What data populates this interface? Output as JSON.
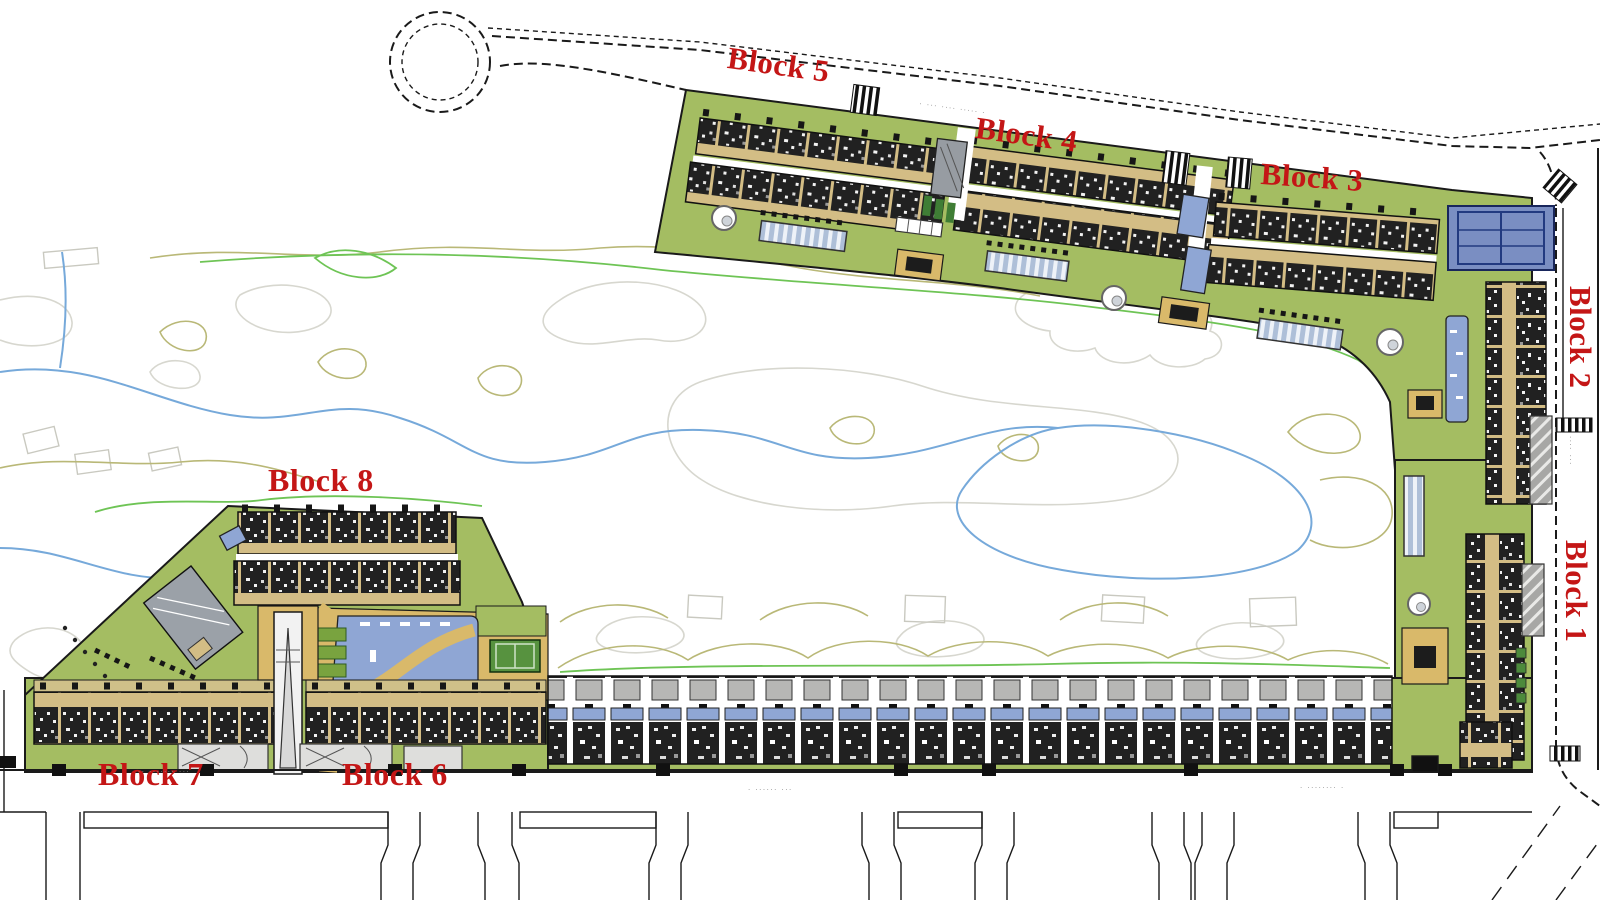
{
  "plan": {
    "type": "residential-masterplan-site-plan",
    "blocks": [
      {
        "label": "Block 1"
      },
      {
        "label": "Block 2"
      },
      {
        "label": "Block 3"
      },
      {
        "label": "Block 4"
      },
      {
        "label": "Block 5"
      },
      {
        "label": "Block 6"
      },
      {
        "label": "Block 7"
      },
      {
        "label": "Block 8"
      }
    ],
    "streets": {
      "top_road": "· ··· ···· ····· ·",
      "bottom_left": "·· ······· ···",
      "bottom_center": "· ······ ···",
      "bottom_right": "· ········ ·",
      "right_road": "···· ···"
    },
    "colors": {
      "label_red": "#c41616",
      "site_green": "#a4bd62",
      "terrace_tan": "#d3bd85",
      "building_dark": "#212121",
      "pool_blue": "#8fa6d4",
      "tennis_blue": "#7a8ec2",
      "sport_court_green": "#57923f",
      "path_tan": "#d9b96a",
      "parking_gray": "#a7a7a5",
      "contour_gray": "#d7d7cf",
      "contour_olive": "#b9b877",
      "contour_blue": "#76a9da",
      "contour_green": "#6ec455",
      "outline_black": "#1a1a1a"
    }
  }
}
